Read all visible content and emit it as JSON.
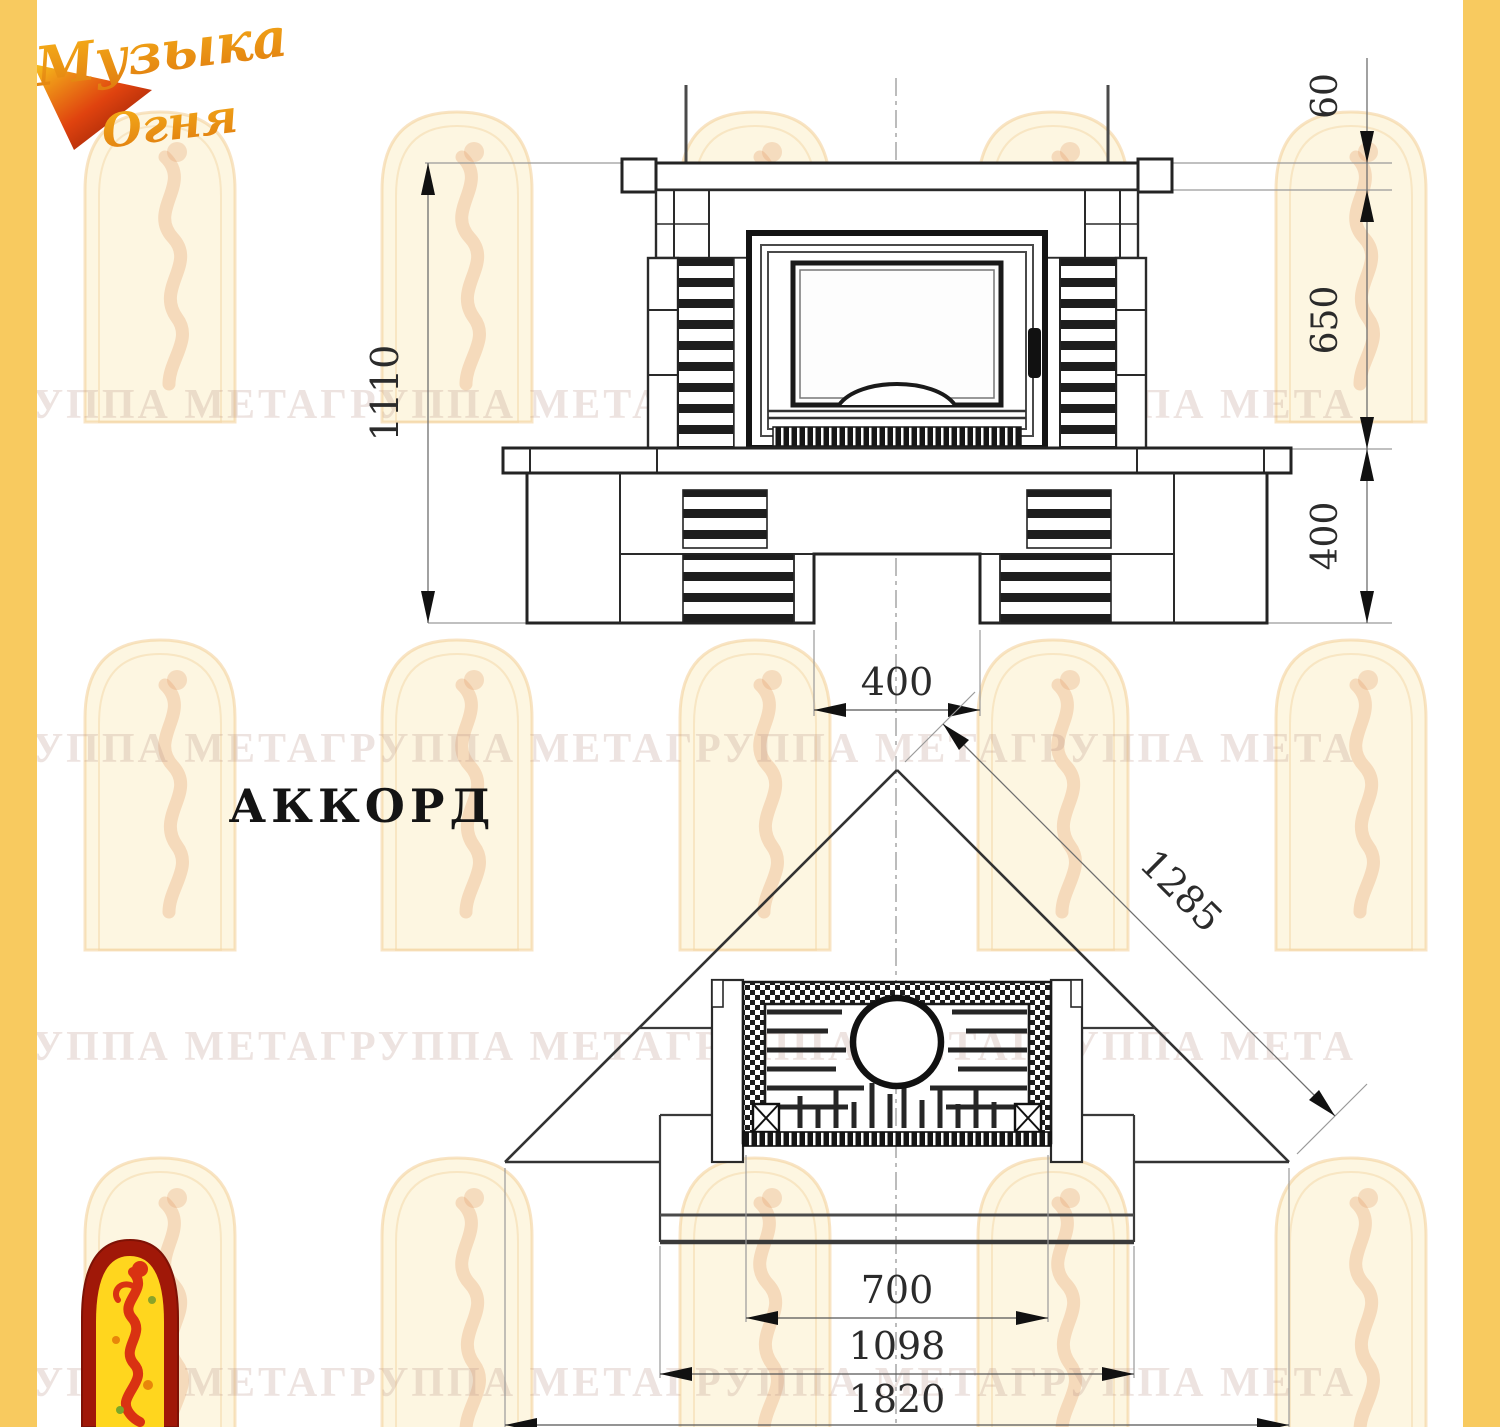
{
  "theme": {
    "stripe_color": "#f8ca5f",
    "paper_color": "#ffffff",
    "line_color": "#222222",
    "logo_orange": "#ef9c13",
    "logo_red": "#c92c0e"
  },
  "brand": {
    "logo_top": {
      "line1": "Музыка",
      "line2": "Огня"
    }
  },
  "watermark": {
    "text": "ГРУППА МЕТАГРУППА МЕТАГРУППА МЕТАГРУППА МЕТА"
  },
  "drawing": {
    "title": "АККОРД",
    "front_view": {
      "dims": {
        "total_height": "1110",
        "mantel_thickness": "60",
        "middle_height": "650",
        "base_height": "400",
        "base_opening_width": "400"
      }
    },
    "plan_view": {
      "dims": {
        "diagonal": "1285",
        "firebox_width": "700",
        "hearth_width": "1098",
        "overall_width": "1820"
      }
    }
  }
}
